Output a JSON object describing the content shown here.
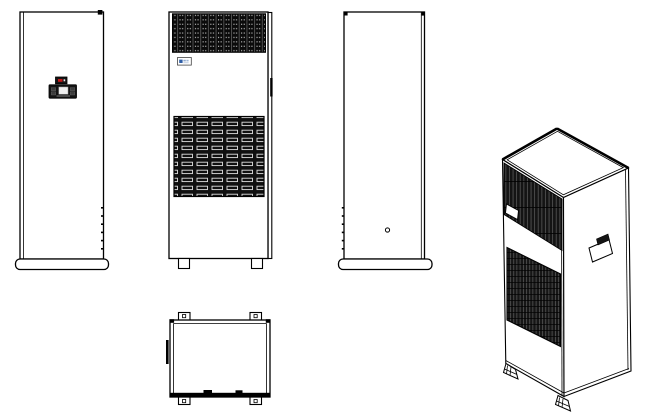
{
  "drawing": {
    "colors": {
      "line": "#000000",
      "paper": "#ffffff",
      "panel-dark": "#141414",
      "grille-dark": "#0d0d0d",
      "logo-blue": "#2e5ea6",
      "logo-blue-light": "#8fa9cc",
      "indicator-red": "#c41818",
      "screen-light": "#f0f0f0"
    },
    "views": [
      {
        "id": "front-view-controller",
        "label": "Cabinet front view with display controller"
      },
      {
        "id": "front-view-grilles",
        "label": "Cabinet front view with perforated and louvered grilles"
      },
      {
        "id": "side-view-plain",
        "label": "Cabinet plain side/rear view with vent hole"
      },
      {
        "id": "top-view",
        "label": "Cabinet top view with corner mounting tabs"
      },
      {
        "id": "isometric-view",
        "label": "Cabinet isometric view with grilles, handle and leveling feet"
      }
    ]
  }
}
